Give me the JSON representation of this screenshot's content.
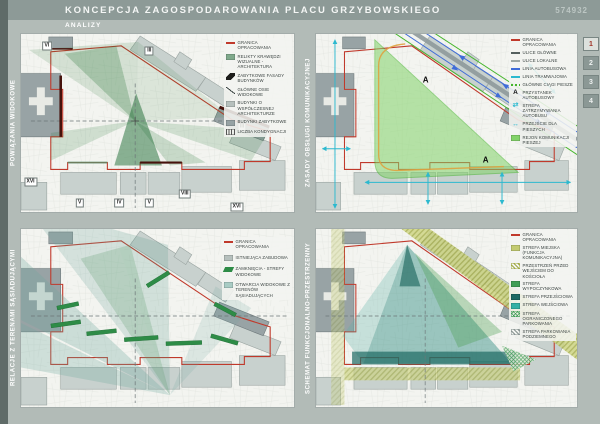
{
  "header": {
    "title": "KONCEPCJA ZAGOSPODAROWANIA PLACU GRZYBOWSKIEGO",
    "sheet_number": "574932",
    "subtitle": "ANALIZY"
  },
  "tabs": [
    {
      "label": "1",
      "active": true
    },
    {
      "label": "2",
      "active": false
    },
    {
      "label": "3",
      "active": false
    },
    {
      "label": "4",
      "active": false
    }
  ],
  "colors": {
    "page_bg": "#b2bbb7",
    "header_bg": "#8d9a97",
    "sidebar_bg": "#5f6b68",
    "map_bg": "#f3f4f0",
    "boundary_red": "#c0392b",
    "heritage_facade": "#46120c",
    "view_cone_green": "#2f7a3c",
    "pedestrian_green": "#82d369",
    "bus_blue": "#3f6cd8",
    "tram_cyan": "#2cb9cf",
    "tram_loop_orange": "#dfa23f",
    "zone_teal": "#2f8b80",
    "zone_olive": "#c3cb70",
    "active_tab_number": "#a03328"
  },
  "panels": [
    {
      "title": "POWIĄZANIA WIDOKOWE",
      "legend": [
        {
          "symbol": "line",
          "color": "#c0392b",
          "label": "GRANICA OPRACOWANIA"
        },
        {
          "symbol": "square",
          "color": "#7fa98b",
          "label": "RELIKTY KRAWĘDZI WIZUALNE - ARCHITEKTURA"
        },
        {
          "symbol": "wedge",
          "color": "#1c1c1a",
          "label": "ZABYTKOWE FASADY BUDYNKÓW"
        },
        {
          "symbol": "axis",
          "color": "#3a4442",
          "label": "GŁÓWNE OSIE WIDOKOWE"
        },
        {
          "symbol": "square",
          "color": "#b6c0bd",
          "label": "BUDYNKI O WSPÓŁCZESNEJ ARCHITEKTURZE"
        },
        {
          "symbol": "square",
          "color": "#96a2a4",
          "label": "BUDYNKI ZABYTKOWE"
        },
        {
          "symbol": "floors",
          "color": "#555555",
          "label": "LICZBA KONDYGNACJI"
        }
      ],
      "markers": [
        {
          "text": "VI",
          "x": 9.5,
          "y": 6.5
        },
        {
          "text": "III",
          "x": 47,
          "y": 9.5
        },
        {
          "text": "III",
          "x": 81,
          "y": 52
        },
        {
          "text": "XVI",
          "x": 3.5,
          "y": 83
        },
        {
          "text": "V",
          "x": 21.5,
          "y": 95
        },
        {
          "text": "IV",
          "x": 36,
          "y": 95
        },
        {
          "text": "V",
          "x": 47,
          "y": 95
        },
        {
          "text": "VIII",
          "x": 60,
          "y": 90
        },
        {
          "text": "XVI",
          "x": 79,
          "y": 97
        }
      ]
    },
    {
      "title": "ZASADY OBSŁUGI KOMUNIKACYJNEJ",
      "legend": [
        {
          "symbol": "line",
          "color": "#c0392b",
          "label": "GRANICA OPRACOWANIA"
        },
        {
          "symbol": "line",
          "color": "#55605f",
          "label": "ULICE GŁÓWNE"
        },
        {
          "symbol": "line",
          "color": "#9fa9a6",
          "label": "ULICE LOKALNE"
        },
        {
          "symbol": "line",
          "color": "#3f6cd8",
          "label": "LINIA AUTOBUSOWA"
        },
        {
          "symbol": "line",
          "color": "#2cb9cf",
          "label": "LINIA TRAMWAJOWA"
        },
        {
          "symbol": "dash",
          "color": "#45b52c",
          "label": "GŁÓWNE CIĄGI PIESZE"
        },
        {
          "symbol": "letter",
          "glyph": "A",
          "label": "PRZYSTANEK AUTOBUSOWY"
        },
        {
          "symbol": "arrow",
          "color": "#2cb9cf",
          "glyph": "⇄",
          "label": "STREFA ZATRZYMYWANIA AUTOBUSU"
        },
        {
          "symbol": "arrow",
          "color": "#2cb9cf",
          "glyph": "↔",
          "label": "PRZEJŚCIE DLA PIESZYCH"
        },
        {
          "symbol": "square",
          "color": "#82d369",
          "label": "REJON KOMUNIKACJI PIESZEJ"
        }
      ],
      "markers": [
        {
          "text": "A",
          "x": 42,
          "y": 26,
          "chip": false
        },
        {
          "text": "A",
          "x": 65,
          "y": 71,
          "chip": false
        }
      ]
    },
    {
      "title": "RELACJE Z TERENAMI SĄSIADUJĄCYMI",
      "legend": [
        {
          "symbol": "line",
          "color": "#c0392b",
          "label": "GRANICA OPRACOWANIA"
        },
        {
          "symbol": "square",
          "color": "#b6c0bd",
          "label": "ISTNIEJĄCA ZABUDOWA"
        },
        {
          "symbol": "bar",
          "color": "#2e8c47",
          "label": "ZAMKNIĘCIA - STREFY WIDOKOWE"
        },
        {
          "symbol": "square",
          "color": "#a9ccc4",
          "label": "OTWARCIA WIDOKOWE Z TERENÓW SĄSIADUJĄCYCH"
        }
      ],
      "markers": []
    },
    {
      "title": "SCHEMAT FUNKCJONALNO-PRZESTRZENNY",
      "legend": [
        {
          "symbol": "line",
          "color": "#c0392b",
          "label": "GRANICA OPRACOWANIA"
        },
        {
          "symbol": "square",
          "color": "#c3cb70",
          "label": "STREFA MIEJSKA (FUNKCJA KOMUNIKACYJNA)"
        },
        {
          "symbol": "hatch",
          "color": "#a2aa45",
          "label": "PRZESTRZEŃ PRZED WEJŚCIEM DO KOŚCIOŁA"
        },
        {
          "symbol": "square",
          "color": "#3f9e55",
          "label": "STREFA WYPOCZYNKOWA"
        },
        {
          "symbol": "square",
          "color": "#1c6a63",
          "label": "STREFA PRZEJŚCIOWA"
        },
        {
          "symbol": "square",
          "color": "#35b0a5",
          "label": "STREFA WEJŚCIOWA"
        },
        {
          "symbol": "cross",
          "color": "#3f9e55",
          "label": "STREFA OGRANICZONEGO PARKOWANIA"
        },
        {
          "symbol": "hatch",
          "color": "#8a9593",
          "label": "STREFA PARKOWANIA PODZIEMNEGO"
        }
      ],
      "markers": []
    }
  ]
}
